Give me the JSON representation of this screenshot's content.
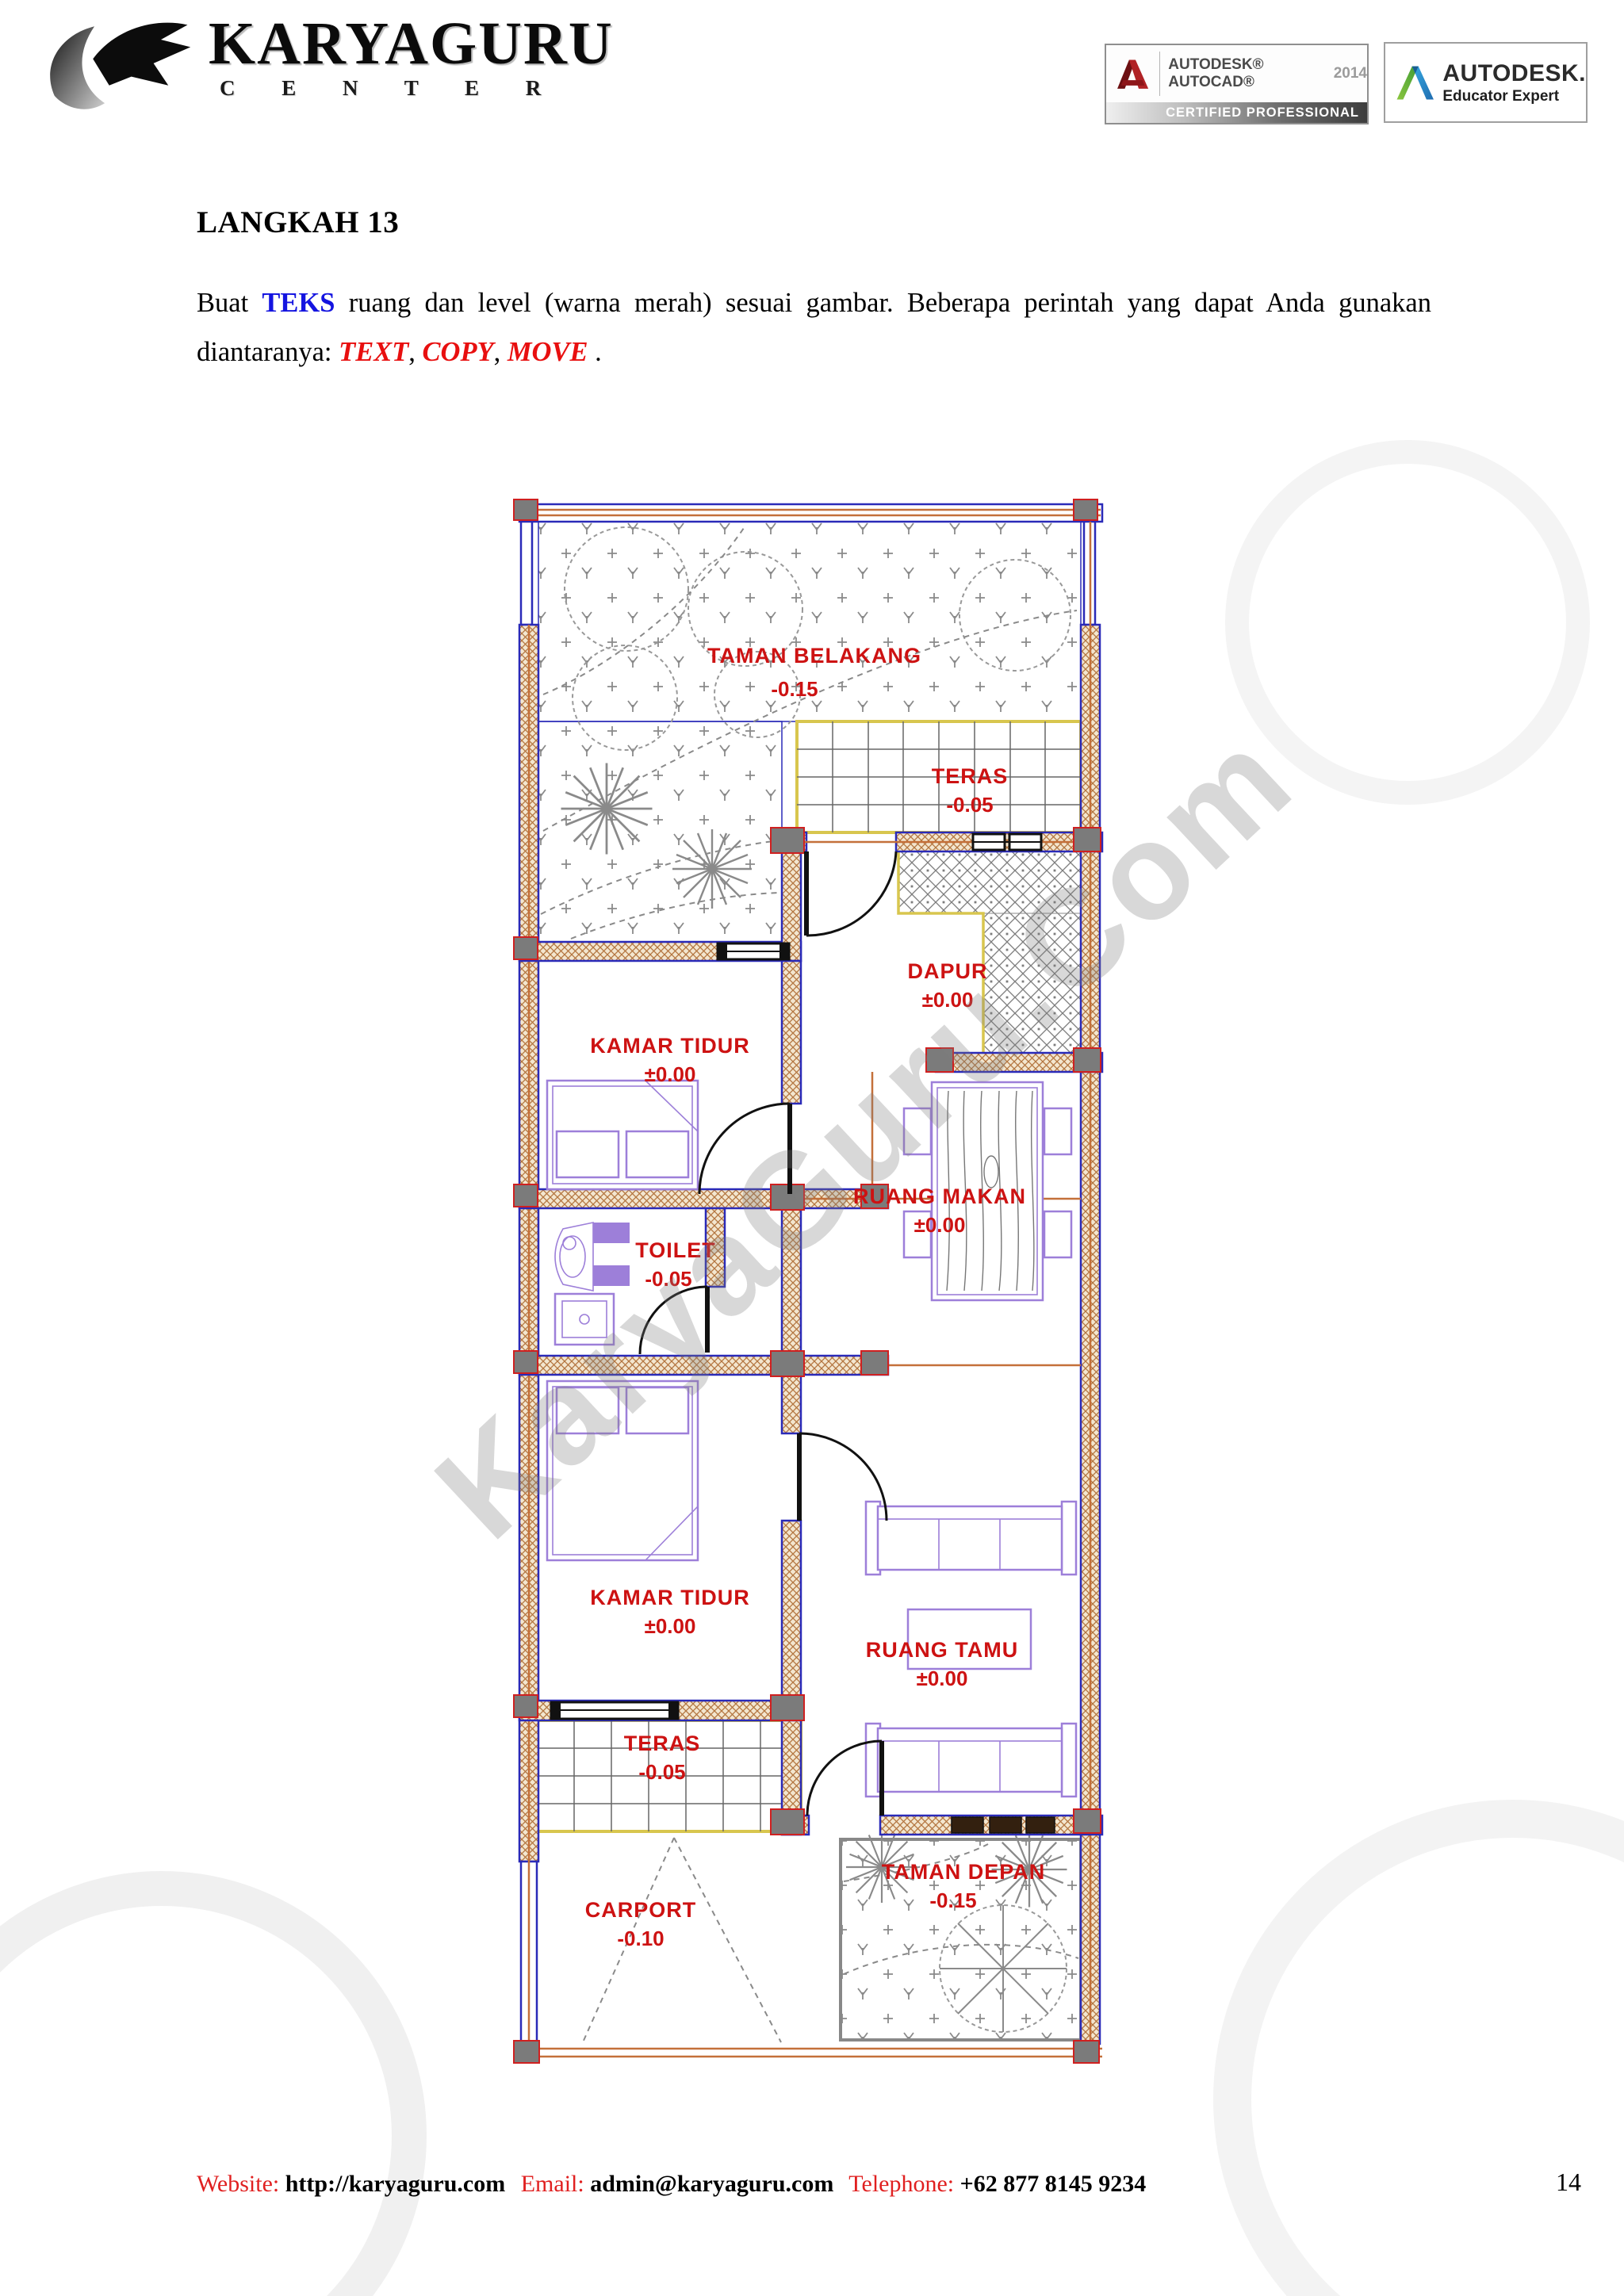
{
  "header": {
    "logo": {
      "brand": "KARYAGURU",
      "subtitle": "C E N T E R"
    },
    "badge_certified": {
      "brand_line": "AUTODESK® AUTOCAD®",
      "year": "2014",
      "bar_text": "CERTIFIED PROFESSIONAL"
    },
    "badge_educator": {
      "brand": "AUTODESK.",
      "subtitle": "Educator Expert"
    }
  },
  "content": {
    "title": "LANGKAH 13",
    "paragraph": {
      "lead": "Buat ",
      "emphasis_blue": "TEKS",
      "body": " ruang dan level (warna merah) sesuai gambar. Beberapa perintah yang dapat Anda gunakan diantaranya: ",
      "cmd1": "TEXT",
      "sep1": ", ",
      "cmd2": "COPY",
      "sep2": ", ",
      "cmd3": "MOVE",
      "tail": " ."
    }
  },
  "floorplan": {
    "watermark": "KaryaGuru.Com",
    "rooms": [
      {
        "name": "TAMAN BELAKANG",
        "level": "-0.15"
      },
      {
        "name": "TERAS",
        "level": "-0.05"
      },
      {
        "name": "DAPUR",
        "level": "±0.00"
      },
      {
        "name": "KAMAR TIDUR",
        "level": "±0.00"
      },
      {
        "name": "RUANG MAKAN",
        "level": "±0.00"
      },
      {
        "name": "TOILET",
        "level": "-0.05"
      },
      {
        "name": "KAMAR TIDUR",
        "level": "±0.00"
      },
      {
        "name": "RUANG TAMU",
        "level": "±0.00"
      },
      {
        "name": "TERAS",
        "level": "-0.05"
      },
      {
        "name": "CARPORT",
        "level": "-0.10"
      },
      {
        "name": "TAMAN DEPAN",
        "level": "-0.15"
      }
    ]
  },
  "footer": {
    "website_label": "Website:",
    "website": "http://karyaguru.com",
    "email_label": "Email:",
    "email": "admin@karyaguru.com",
    "phone_label": "Telephone:",
    "phone": "+62 877 8145 9234",
    "page_number": "14"
  },
  "colors": {
    "label_red": "#cd1212",
    "wall_blue": "#2a2ab8",
    "hatch_brown": "#b3753f",
    "furniture_purple": "#9d7fd9",
    "teras_yellow": "#d8c64e",
    "axis_orange": "#c4703a",
    "text_blue": "#1414e0",
    "command_red": "#e80f0f"
  }
}
